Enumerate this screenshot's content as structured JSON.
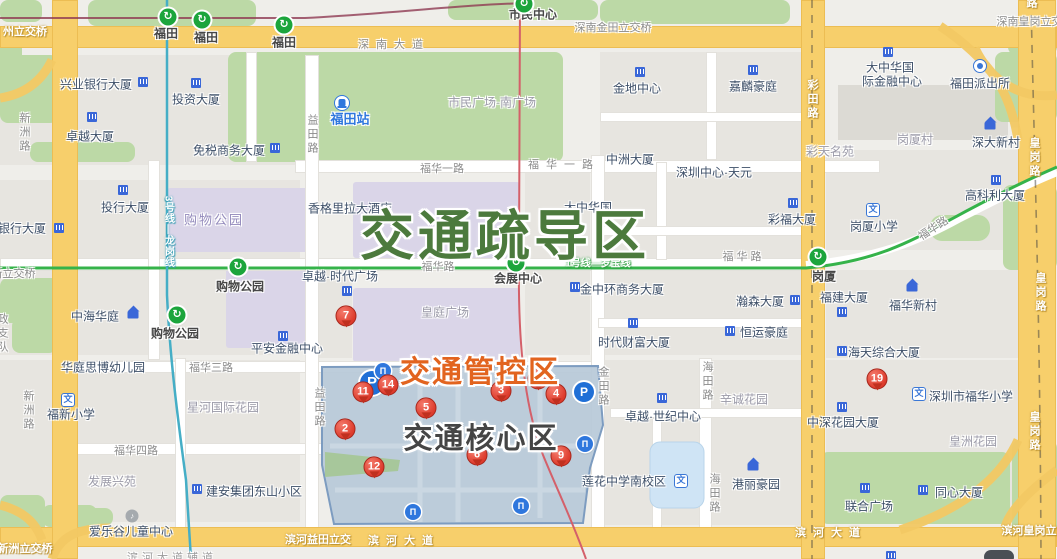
{
  "title": "福田中心区交通管制示意图",
  "zones": {
    "shudao": {
      "label": "交通疏导区",
      "color": "#4c7a3d"
    },
    "guankong": {
      "label": "交通管控区",
      "color": "#e2641f"
    },
    "hexin": {
      "label": "交通核心区",
      "color": "#454545"
    }
  },
  "palette": {
    "metro_green": "#35b34a",
    "metro_teal": "#45aec6",
    "metro_red": "#d4606a",
    "metro_maroon": "#8f3a52",
    "road_yellow": "#f7cf6b",
    "park_green": "#bcd9a6",
    "zone_blue": "#b7c9d8",
    "pin_red": "#dd3b2c",
    "icon_blue": "#2f77dd",
    "purple_block": "#dad5e8"
  },
  "metro_stations": [
    {
      "label": "福田",
      "ix": 168,
      "iy": 17,
      "lx": 166,
      "ly": 33
    },
    {
      "label": "福田",
      "ix": 202,
      "iy": 20,
      "lx": 206,
      "ly": 37
    },
    {
      "label": "福田",
      "ix": 284,
      "iy": 25,
      "lx": 284,
      "ly": 42
    },
    {
      "label": "市民中心",
      "ix": 524,
      "iy": 4,
      "lx": 533,
      "ly": 14
    },
    {
      "label": "购物公园",
      "ix": 238,
      "iy": 267,
      "lx": 240,
      "ly": 286
    },
    {
      "label": "购物公园",
      "ix": 177,
      "iy": 315,
      "lx": 175,
      "ly": 333
    },
    {
      "label": "会展中心",
      "ix": 516,
      "iy": 263,
      "lx": 518,
      "ly": 278
    },
    {
      "label": "岗厦",
      "ix": 818,
      "iy": 257,
      "lx": 824,
      "ly": 276
    }
  ],
  "station_glyph": "↻",
  "entrance_glyph": "П",
  "parking_glyph": "P",
  "pins": [
    {
      "n": "7",
      "x": 346,
      "y": 318
    },
    {
      "n": "11",
      "x": 363,
      "y": 394
    },
    {
      "n": "14",
      "x": 388,
      "y": 387
    },
    {
      "n": "2",
      "x": 345,
      "y": 431
    },
    {
      "n": "5",
      "x": 426,
      "y": 410
    },
    {
      "n": "3",
      "x": 501,
      "y": 393
    },
    {
      "n": "10",
      "x": 538,
      "y": 381
    },
    {
      "n": "4",
      "x": 556,
      "y": 396
    },
    {
      "n": "12",
      "x": 374,
      "y": 469
    },
    {
      "n": "6",
      "x": 477,
      "y": 457
    },
    {
      "n": "9",
      "x": 561,
      "y": 458
    },
    {
      "n": "19",
      "x": 877,
      "y": 381
    }
  ],
  "parking": [
    {
      "x": 372,
      "y": 383,
      "s": 24
    },
    {
      "x": 584,
      "y": 392,
      "s": 20
    }
  ],
  "entrances": [
    {
      "x": 383,
      "y": 371
    },
    {
      "x": 585,
      "y": 444
    },
    {
      "x": 413,
      "y": 512
    },
    {
      "x": 521,
      "y": 506
    }
  ],
  "icons": [
    {
      "t": "bld",
      "x": 143,
      "y": 82
    },
    {
      "t": "bld",
      "x": 196,
      "y": 83
    },
    {
      "t": "bld",
      "x": 92,
      "y": 117
    },
    {
      "t": "bld",
      "x": 275,
      "y": 148
    },
    {
      "t": "bld",
      "x": 123,
      "y": 190
    },
    {
      "t": "bld",
      "x": 59,
      "y": 228
    },
    {
      "t": "bld",
      "x": 283,
      "y": 336
    },
    {
      "t": "bld",
      "x": 347,
      "y": 291
    },
    {
      "t": "bld",
      "x": 575,
      "y": 287
    },
    {
      "t": "bld",
      "x": 795,
      "y": 300
    },
    {
      "t": "bld",
      "x": 730,
      "y": 331
    },
    {
      "t": "bld",
      "x": 633,
      "y": 323
    },
    {
      "t": "bld",
      "x": 793,
      "y": 203
    },
    {
      "t": "bld",
      "x": 640,
      "y": 72
    },
    {
      "t": "bld",
      "x": 753,
      "y": 70
    },
    {
      "t": "bld",
      "x": 888,
      "y": 52
    },
    {
      "t": "bld",
      "x": 996,
      "y": 180
    },
    {
      "t": "bld",
      "x": 842,
      "y": 351
    },
    {
      "t": "bld",
      "x": 842,
      "y": 312
    },
    {
      "t": "bld",
      "x": 662,
      "y": 398
    },
    {
      "t": "bld",
      "x": 923,
      "y": 490
    },
    {
      "t": "bld",
      "x": 865,
      "y": 488
    },
    {
      "t": "bld",
      "x": 197,
      "y": 489
    },
    {
      "t": "bld",
      "x": 842,
      "y": 407
    },
    {
      "t": "bld",
      "x": 891,
      "y": 556
    },
    {
      "t": "house",
      "x": 133,
      "y": 315
    },
    {
      "t": "house",
      "x": 990,
      "y": 126
    },
    {
      "t": "house",
      "x": 912,
      "y": 288
    },
    {
      "t": "house",
      "x": 753,
      "y": 467
    },
    {
      "t": "school",
      "g": "文",
      "x": 68,
      "y": 400
    },
    {
      "t": "school",
      "g": "文",
      "x": 873,
      "y": 210
    },
    {
      "t": "school",
      "g": "文",
      "x": 919,
      "y": 394
    },
    {
      "t": "school",
      "g": "文",
      "x": 681,
      "y": 481
    },
    {
      "t": "police",
      "x": 980,
      "y": 66
    },
    {
      "t": "train",
      "x": 342,
      "y": 103
    },
    {
      "t": "misc",
      "g": "♪",
      "x": 132,
      "y": 516
    },
    {
      "t": "car",
      "x": 999,
      "y": 557
    }
  ],
  "labels": [
    {
      "t": "兴业银行大厦",
      "x": 96,
      "y": 84
    },
    {
      "t": "投资大厦",
      "x": 196,
      "y": 99
    },
    {
      "t": "卓越大厦",
      "x": 90,
      "y": 136
    },
    {
      "t": "免税商务大厦",
      "x": 229,
      "y": 150
    },
    {
      "t": "投行大厦",
      "x": 125,
      "y": 207
    },
    {
      "t": "银行大厦",
      "x": 22,
      "y": 228
    },
    {
      "t": "中海华庭",
      "x": 95,
      "y": 316
    },
    {
      "t": "平安金融中心",
      "x": 287,
      "y": 348
    },
    {
      "t": "香格里拉大酒店",
      "x": 350,
      "y": 208
    },
    {
      "t": "卓越·时代广场",
      "x": 340,
      "y": 276
    },
    {
      "t": "大中华国",
      "x": 588,
      "y": 207
    },
    {
      "t": "金中环商务大厦",
      "x": 622,
      "y": 289
    },
    {
      "t": "瀚森大厦",
      "x": 760,
      "y": 301
    },
    {
      "t": "恒运豪庭",
      "x": 764,
      "y": 332
    },
    {
      "t": "时代财富大厦",
      "x": 634,
      "y": 342
    },
    {
      "t": "深圳中心·天元",
      "x": 714,
      "y": 172
    },
    {
      "t": "彩福大厦",
      "x": 792,
      "y": 219
    },
    {
      "t": "中洲大厦",
      "x": 630,
      "y": 159
    },
    {
      "t": "金地中心",
      "x": 637,
      "y": 88
    },
    {
      "t": "嘉麟豪庭",
      "x": 753,
      "y": 86
    },
    {
      "t": "大中华国",
      "x": 890,
      "y": 67
    },
    {
      "t": "际金融中心",
      "x": 892,
      "y": 81
    },
    {
      "t": "福田派出所",
      "x": 980,
      "y": 83
    },
    {
      "t": "深大新村",
      "x": 996,
      "y": 142
    },
    {
      "t": "高科利大厦",
      "x": 995,
      "y": 195
    },
    {
      "t": "岗厦小学",
      "x": 874,
      "y": 226
    },
    {
      "t": "福华新村",
      "x": 913,
      "y": 305
    },
    {
      "t": "海天综合大厦",
      "x": 884,
      "y": 352
    },
    {
      "t": "福建大厦",
      "x": 844,
      "y": 297
    },
    {
      "t": "中深花园大厦",
      "x": 843,
      "y": 422
    },
    {
      "t": "深圳市福华小学",
      "x": 971,
      "y": 396
    },
    {
      "t": "同心大厦",
      "x": 959,
      "y": 492
    },
    {
      "t": "联合广场",
      "x": 869,
      "y": 506
    },
    {
      "t": "卓越·世纪中心",
      "x": 663,
      "y": 416
    },
    {
      "t": "莲花中学南校区",
      "x": 624,
      "y": 481
    },
    {
      "t": "港丽豪园",
      "x": 756,
      "y": 484
    },
    {
      "t": "建安集团东山小区",
      "x": 254,
      "y": 491
    },
    {
      "t": "爱乐谷儿童中心",
      "x": 131,
      "y": 531
    },
    {
      "t": "华庭思博幼儿园",
      "x": 103,
      "y": 367
    },
    {
      "t": "福新小学",
      "x": 71,
      "y": 414
    },
    {
      "t": "福田站",
      "x": 350,
      "y": 118,
      "c": "stb"
    },
    {
      "t": "市民广场·南广场",
      "x": 492,
      "y": 102,
      "c": "a"
    },
    {
      "t": "购物公园",
      "x": 214,
      "y": 219,
      "c": "ap"
    },
    {
      "t": "皇庭广场",
      "x": 445,
      "y": 312,
      "c": "a"
    },
    {
      "t": "星河国际花园",
      "x": 223,
      "y": 407,
      "c": "a"
    },
    {
      "t": "发展兴苑",
      "x": 112,
      "y": 481,
      "c": "a"
    },
    {
      "t": "辛诚花园",
      "x": 744,
      "y": 399,
      "c": "a"
    },
    {
      "t": "皇洲花园",
      "x": 973,
      "y": 441,
      "c": "a"
    },
    {
      "t": "岗厦村",
      "x": 915,
      "y": 139,
      "c": "a"
    },
    {
      "t": "彩天名苑",
      "x": 830,
      "y": 151,
      "c": "a"
    },
    {
      "t": "深南大道",
      "x": 394,
      "y": 44,
      "c": "rsp"
    },
    {
      "t": "州立交桥",
      "x": 25,
      "y": 31,
      "c": "rw"
    },
    {
      "t": "深南金田立交桥",
      "x": 613,
      "y": 27,
      "c": "r"
    },
    {
      "t": "深南皇岗立交桥",
      "x": 1035,
      "y": 21,
      "c": "r"
    },
    {
      "t": "福华一路",
      "x": 442,
      "y": 168,
      "c": "r"
    },
    {
      "t": "福华一路",
      "x": 564,
      "y": 164,
      "c": "rsp"
    },
    {
      "t": "福华路",
      "x": 438,
      "y": 266,
      "c": "r"
    },
    {
      "t": "福 华 路",
      "x": 742,
      "y": 256,
      "c": "r"
    },
    {
      "t": "福华路",
      "x": 933,
      "y": 228,
      "c": "r",
      "rot": -33
    },
    {
      "t": "福华三路",
      "x": 211,
      "y": 367,
      "c": "r"
    },
    {
      "t": "福华四路",
      "x": 136,
      "y": 450,
      "c": "r"
    },
    {
      "t": "滨河益田立交",
      "x": 318,
      "y": 539,
      "c": "rw"
    },
    {
      "t": "滨河大道",
      "x": 404,
      "y": 540,
      "c": "rwsp"
    },
    {
      "t": "滨河大道",
      "x": 831,
      "y": 532,
      "c": "rwsp"
    },
    {
      "t": "滨河皇岗立交桥",
      "x": 1040,
      "y": 530,
      "c": "rw"
    },
    {
      "t": "滨河新洲立交桥",
      "x": 14,
      "y": 548,
      "c": "rw"
    },
    {
      "t": "滨河大道辅道",
      "x": 172,
      "y": 557,
      "c": "g9"
    },
    {
      "t": "福新立交桥",
      "x": 8,
      "y": 273,
      "c": "r"
    },
    {
      "t": "新洲路",
      "x": 24,
      "y": 133,
      "c": "rv"
    },
    {
      "t": "新洲路",
      "x": 28,
      "y": 411,
      "c": "rv"
    },
    {
      "t": "益田路",
      "x": 312,
      "y": 135,
      "c": "rv"
    },
    {
      "t": "益田路",
      "x": 319,
      "y": 408,
      "c": "rv"
    },
    {
      "t": "金田路",
      "x": 603,
      "y": 387,
      "c": "rv"
    },
    {
      "t": "海田路",
      "x": 707,
      "y": 382,
      "c": "rv"
    },
    {
      "t": "海田路",
      "x": 714,
      "y": 494,
      "c": "rv"
    },
    {
      "t": "彩田路",
      "x": 812,
      "y": 100,
      "c": "rvy"
    },
    {
      "t": "皇岗路",
      "x": 1031,
      "y": -10,
      "c": "rvy"
    },
    {
      "t": "皇岗路",
      "x": 1034,
      "y": 158,
      "c": "rvy"
    },
    {
      "t": "皇岗路",
      "x": 1040,
      "y": 293,
      "c": "rvy"
    },
    {
      "t": "皇岗路",
      "x": 1034,
      "y": 432,
      "c": "rvy"
    },
    {
      "t": "政支队",
      "x": 2,
      "y": 334,
      "c": "rv"
    },
    {
      "t": "1号线—罗宝线",
      "x": 598,
      "y": 262,
      "c": "ml"
    },
    {
      "t": "3号线—龙岗线",
      "x": 168,
      "y": 232,
      "c": "mlv"
    }
  ]
}
